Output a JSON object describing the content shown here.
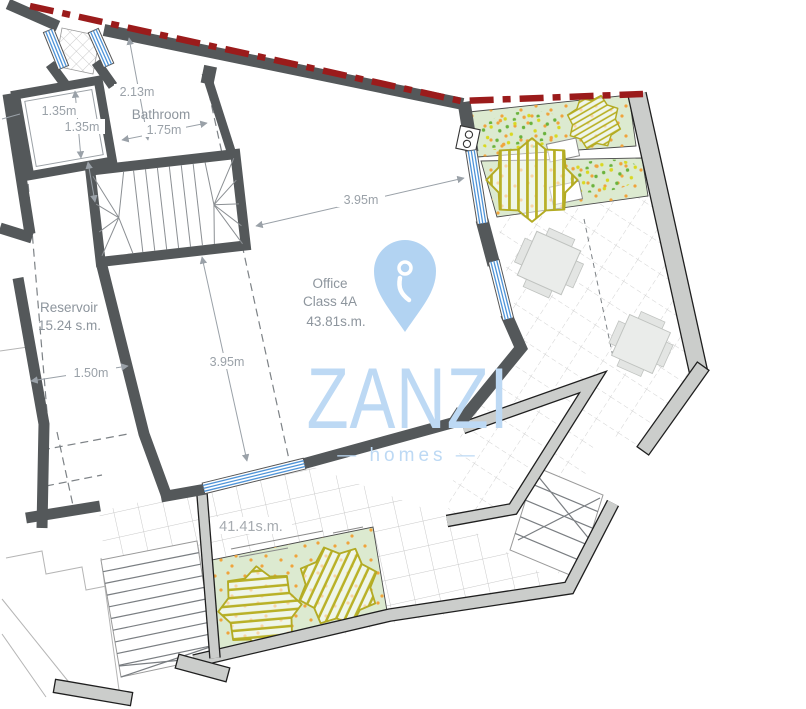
{
  "plan": {
    "labels": {
      "bathroom": "Bathroom",
      "reservoir_name": "Reservoir",
      "reservoir_area": "15.24 s.m.",
      "office_name": "Office",
      "office_class": "Class 4A",
      "office_area": "43.81s.m.",
      "terrace_area": "41.41s.m."
    },
    "dimensions": {
      "d213": "2.13m",
      "d135a": "1.35m",
      "d135b": "1.35m",
      "d175": "1.75m",
      "d395h": "3.95m",
      "d395v": "3.95m",
      "d150": "1.50m"
    }
  },
  "watermark": {
    "brand": "ZANZI",
    "tagline": "— homes —"
  },
  "icons": {
    "marker": "location-pin-icon"
  },
  "colors": {
    "boundary_red": "#9b1b1b",
    "wall_dark": "#54585a",
    "wall_light": "#cbcdcb",
    "wall_light_outline": "#1f1f1f",
    "garden_green": "#dcead0",
    "tree_olive": "#b3ab24",
    "window_blue": "#4f94d8",
    "logo_blue": "#bdd9f4",
    "pin_blue": "#b2d3f2",
    "dot_orange": "#f0a43c",
    "dot_green": "#6ab33c",
    "dot_yellow": "#d9d821",
    "tile_line": "#c9c9c9",
    "dim_gray": "#9aa1a8"
  }
}
